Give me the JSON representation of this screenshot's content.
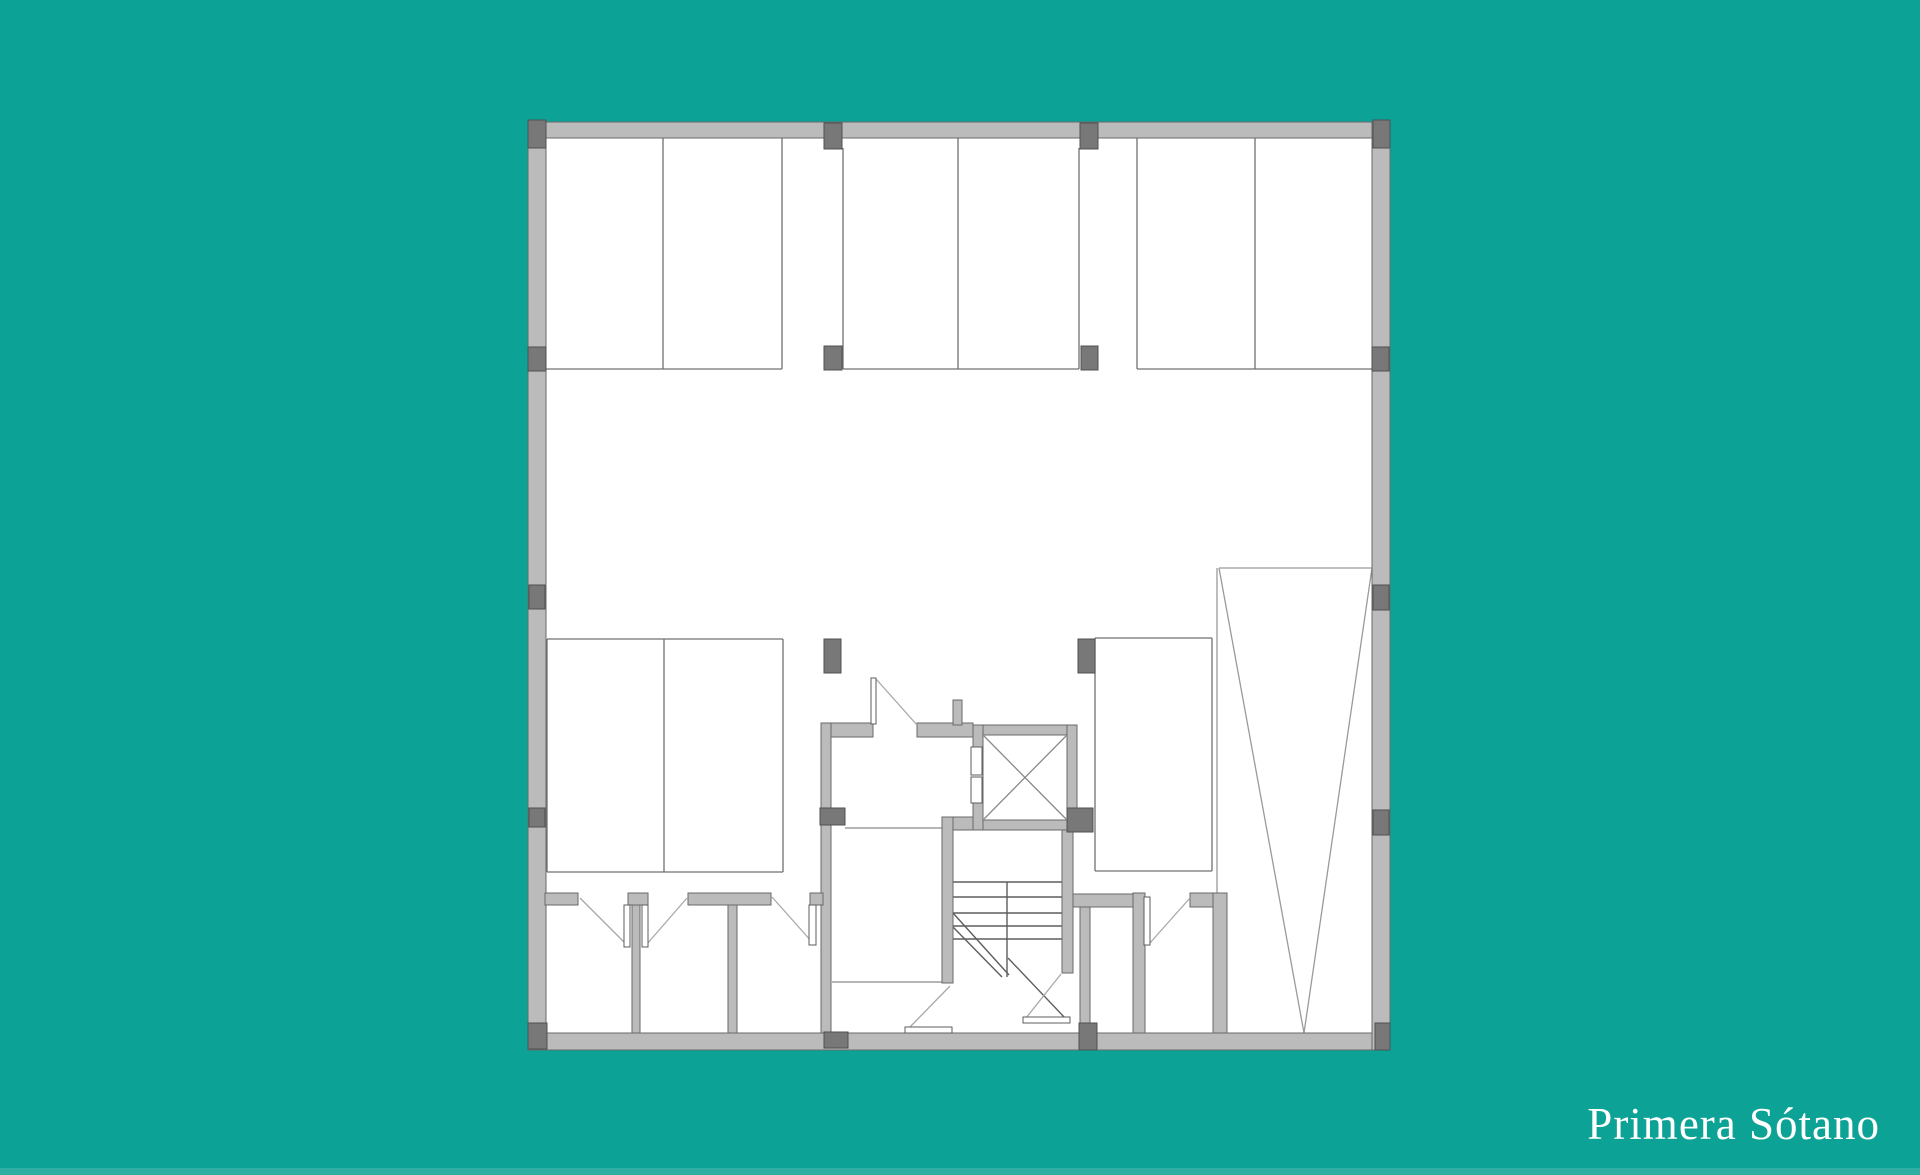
{
  "title": {
    "text": "Primera Sótano"
  },
  "colors": {
    "background": "#0DA296",
    "bottom_strip": "#2FAFA3",
    "floor": "#FFFFFF",
    "wall_fill": "#BBBBBB",
    "wall_stroke": "#6A6A6A",
    "column_fill": "#787878",
    "column_stroke": "#515151",
    "stall_line": "#707070",
    "ramp_line": "#9A9A9A",
    "core_line": "#8A8A8A",
    "stair_line": "#5E5E5E",
    "elevator_x_line": "#8A8A8A",
    "door_panel_fill": "#FFFFFF",
    "door_panel_stroke": "#5E5E5E",
    "door_swing_line": "#A8A8A8",
    "title_color": "#FFFFFF"
  },
  "plan": {
    "floor": [
      528,
      122,
      862,
      928
    ],
    "walls": [
      [
        528,
        122,
        862,
        16
      ],
      [
        528,
        1033,
        862,
        17
      ],
      [
        528,
        122,
        18,
        928
      ],
      [
        1372,
        122,
        18,
        928
      ],
      [
        821,
        723,
        52,
        14
      ],
      [
        917,
        723,
        56,
        14
      ],
      [
        821,
        723,
        10,
        310
      ],
      [
        953,
        700,
        9,
        25
      ],
      [
        942,
        817,
        131,
        13
      ],
      [
        942,
        817,
        11,
        166
      ],
      [
        1062,
        830,
        11,
        143
      ],
      [
        1080,
        897,
        10,
        136
      ],
      [
        545,
        893,
        33,
        12
      ],
      [
        628,
        893,
        20,
        12
      ],
      [
        688,
        893,
        83,
        12
      ],
      [
        810,
        893,
        13,
        12
      ],
      [
        1073,
        894,
        60,
        13
      ],
      [
        1190,
        893,
        37,
        14
      ],
      [
        1133,
        893,
        12,
        140
      ],
      [
        1213,
        893,
        14,
        140
      ],
      [
        632,
        905,
        8,
        128
      ],
      [
        728,
        905,
        9,
        128
      ],
      [
        973,
        725,
        104,
        10
      ],
      [
        1067,
        725,
        10,
        105
      ],
      [
        973,
        820,
        104,
        10
      ],
      [
        973,
        725,
        10,
        22
      ],
      [
        973,
        803,
        10,
        27
      ]
    ],
    "columns": [
      [
        528,
        120,
        18,
        28
      ],
      [
        824,
        123,
        18,
        26
      ],
      [
        1080,
        123,
        18,
        26
      ],
      [
        1373,
        120,
        17,
        28
      ],
      [
        528,
        347,
        18,
        24
      ],
      [
        824,
        346,
        18,
        24
      ],
      [
        1081,
        346,
        17,
        24
      ],
      [
        1372,
        347,
        17,
        24
      ],
      [
        529,
        585,
        16,
        24
      ],
      [
        1373,
        585,
        16,
        25
      ],
      [
        824,
        639,
        17,
        34
      ],
      [
        1078,
        639,
        17,
        34
      ],
      [
        529,
        808,
        16,
        19
      ],
      [
        820,
        808,
        25,
        17
      ],
      [
        1067,
        808,
        26,
        24
      ],
      [
        1373,
        810,
        16,
        25
      ],
      [
        528,
        1023,
        19,
        26
      ],
      [
        824,
        1032,
        24,
        16
      ],
      [
        1079,
        1023,
        18,
        27
      ],
      [
        1375,
        1023,
        15,
        27
      ]
    ],
    "stall_lines": [
      [
        663,
        138,
        663,
        369
      ],
      [
        782,
        138,
        782,
        369
      ],
      [
        546,
        369,
        782,
        369
      ],
      [
        843,
        148,
        843,
        369
      ],
      [
        958,
        138,
        958,
        369
      ],
      [
        1079,
        148,
        1079,
        369
      ],
      [
        843,
        369,
        1079,
        369
      ],
      [
        1137,
        138,
        1137,
        369
      ],
      [
        1255,
        138,
        1255,
        369
      ],
      [
        1137,
        369,
        1372,
        369
      ],
      [
        547,
        639,
        783,
        639
      ],
      [
        547,
        872,
        783,
        872
      ],
      [
        547,
        639,
        547,
        872
      ],
      [
        783,
        639,
        783,
        872
      ],
      [
        664,
        639,
        664,
        872
      ],
      [
        1095,
        638,
        1212,
        638
      ],
      [
        1095,
        871,
        1212,
        871
      ],
      [
        1095,
        638,
        1095,
        871
      ],
      [
        1212,
        638,
        1212,
        871
      ]
    ],
    "ramp_lines": [
      [
        1217,
        568,
        1217,
        893
      ],
      [
        1219,
        568,
        1372,
        568
      ],
      [
        1219,
        568,
        1304,
        1033
      ],
      [
        1372,
        568,
        1304,
        1033
      ]
    ],
    "core_lines": [
      [
        845,
        828,
        942,
        828
      ],
      [
        832,
        982,
        942,
        982
      ]
    ],
    "stair": {
      "treads": [
        [
          953,
          882,
          1062,
          882
        ],
        [
          953,
          897,
          1062,
          897
        ],
        [
          953,
          913,
          1062,
          913
        ],
        [
          953,
          926,
          1062,
          926
        ],
        [
          953,
          939,
          1062,
          939
        ]
      ],
      "center": [
        1007,
        882,
        1007,
        977
      ],
      "diagonals": [
        [
          953,
          913,
          1009,
          975
        ],
        [
          953,
          927,
          1002,
          977
        ],
        [
          1008,
          958,
          1066,
          1019
        ]
      ]
    },
    "elevator": {
      "inner": [
        983,
        735,
        84,
        85
      ],
      "x_lines": [
        [
          984,
          736,
          1066,
          819
        ],
        [
          1066,
          736,
          984,
          819
        ]
      ],
      "door_leaves": [
        [
          971,
          747,
          11,
          28
        ],
        [
          971,
          777,
          11,
          26
        ]
      ]
    },
    "door_panels": [
      [
        871,
        678,
        5,
        46
      ],
      [
        624,
        905,
        6,
        42
      ],
      [
        642,
        905,
        6,
        42
      ],
      [
        809,
        905,
        7,
        40
      ],
      [
        905,
        1027,
        47,
        6
      ],
      [
        1023,
        1017,
        47,
        6
      ],
      [
        1144,
        897,
        6,
        48
      ]
    ],
    "door_swings": [
      [
        876,
        679,
        917,
        725
      ],
      [
        580,
        898,
        626,
        944
      ],
      [
        687,
        898,
        647,
        944
      ],
      [
        772,
        897,
        812,
        942
      ],
      [
        950,
        986,
        909,
        1028
      ],
      [
        1061,
        974,
        1026,
        1018
      ],
      [
        1149,
        944,
        1190,
        898
      ]
    ]
  }
}
